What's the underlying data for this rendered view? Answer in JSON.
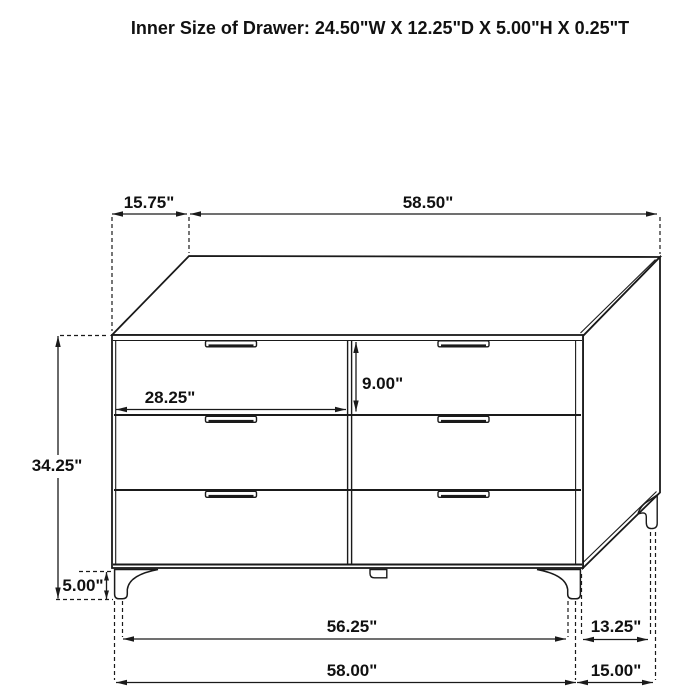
{
  "title": "Inner Size of Drawer: 24.50\"W X 12.25\"D X 5.00\"H X 0.25\"T",
  "diagram": {
    "background": "#ffffff",
    "line_color": "#1a1a1a",
    "dimensions": {
      "top_depth": "15.75\"",
      "top_width": "58.50\"",
      "overall_height": "34.25\"",
      "drawer_front_width": "28.25\"",
      "drawer_front_height": "9.00\"",
      "leg_height": "5.00\"",
      "base_inner_width": "56.25\"",
      "base_width": "58.00\"",
      "base_inner_depth": "13.25\"",
      "base_depth": "15.00\""
    }
  }
}
